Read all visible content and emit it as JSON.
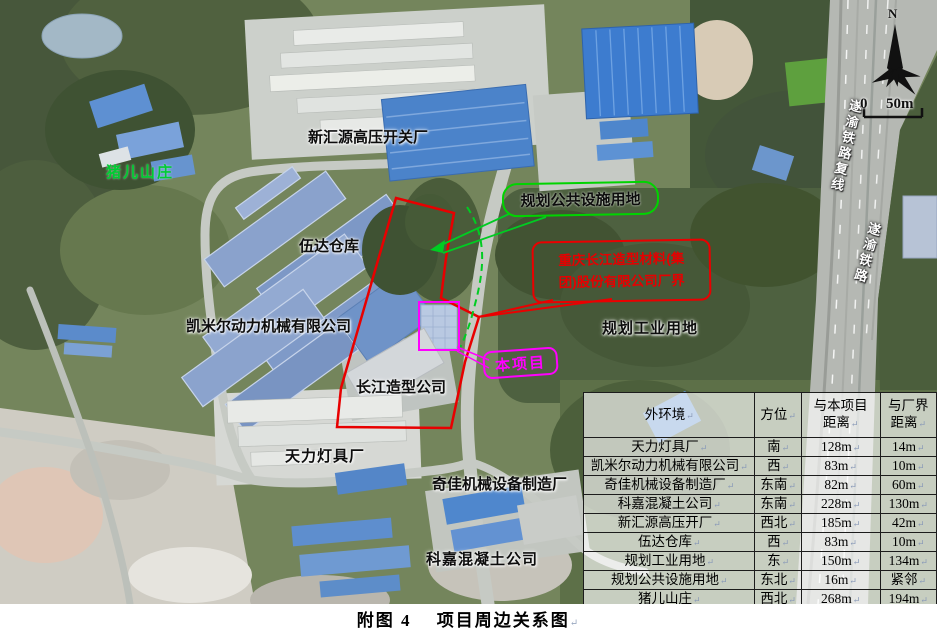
{
  "figure": {
    "caption": "附图 4　 项目周边关系图"
  },
  "colors": {
    "boundary_red": "#e60000",
    "project_magenta": "#ff00ff",
    "planning_green": "#00d400",
    "village_label_green": "#00cc33"
  },
  "map": {
    "labels": {
      "xinhuiyuan": {
        "text": "新汇源高压开关厂"
      },
      "zhuer": {
        "text": "猪儿山庄"
      },
      "wuda": {
        "text": "伍达仓库"
      },
      "kaimier": {
        "text": "凯米尔动力机械有限公司"
      },
      "changjiang": {
        "text": "长江造型公司"
      },
      "tianli": {
        "text": "天力灯具厂"
      },
      "qijia": {
        "text": "奇佳机械设备制造厂"
      },
      "kejia": {
        "text": "科嘉混凝土公司"
      },
      "guihua_gongye": {
        "text": "规划工业用地"
      }
    },
    "callouts": {
      "planning_public": {
        "text": "规划公共设施用地"
      },
      "factory_boundary": {
        "line1": "重庆长江造型材料(集",
        "line2": "团)股份有限公司厂界"
      },
      "project": {
        "text": "本项目"
      }
    },
    "railway": {
      "line1": "遂渝铁路复线",
      "line2": "遂渝铁路"
    },
    "compass": {
      "north": "N"
    },
    "scale": {
      "zero": "0",
      "label": "50m"
    }
  },
  "table": {
    "headers": [
      "外环境",
      "方位",
      "与本项目\n距离",
      "与厂界\n距离"
    ],
    "rows": [
      {
        "name": "天力灯具厂",
        "direction": "南",
        "dist_project": "128m",
        "dist_boundary": "14m"
      },
      {
        "name": "凯米尔动力机械有限公司",
        "direction": "西",
        "dist_project": "83m",
        "dist_boundary": "10m"
      },
      {
        "name": "奇佳机械设备制造厂",
        "direction": "东南",
        "dist_project": "82m",
        "dist_boundary": "60m"
      },
      {
        "name": "科嘉混凝土公司",
        "direction": "东南",
        "dist_project": "228m",
        "dist_boundary": "130m"
      },
      {
        "name": "新汇源高压开厂",
        "direction": "西北",
        "dist_project": "185m",
        "dist_boundary": "42m"
      },
      {
        "name": "伍达仓库",
        "direction": "西",
        "dist_project": "83m",
        "dist_boundary": "10m"
      },
      {
        "name": "规划工业用地",
        "direction": "东",
        "dist_project": "150m",
        "dist_boundary": "134m"
      },
      {
        "name": "规划公共设施用地",
        "direction": "东北",
        "dist_project": "16m",
        "dist_boundary": "紧邻"
      },
      {
        "name": "猪儿山庄",
        "direction": "西北",
        "dist_project": "268m",
        "dist_boundary": "194m"
      }
    ]
  }
}
